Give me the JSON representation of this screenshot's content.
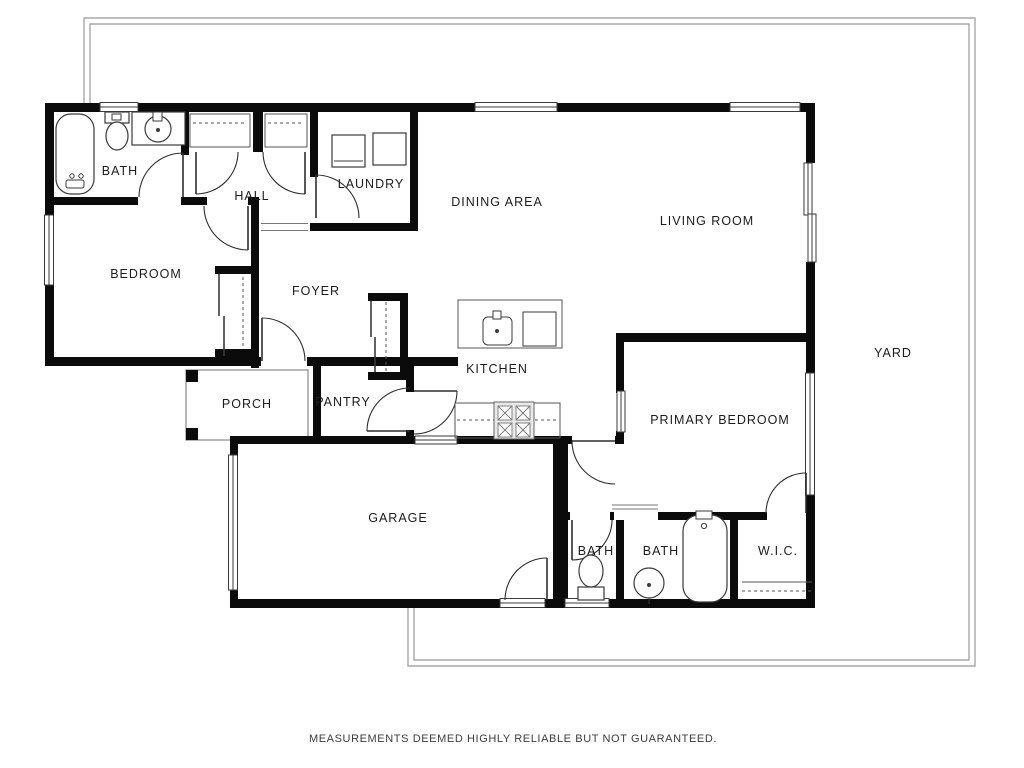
{
  "floor_plan": {
    "disclaimer": "MEASUREMENTS DEEMED HIGHLY RELIABLE BUT NOT GUARANTEED.",
    "rooms": [
      {
        "id": "bath",
        "name": "BATH"
      },
      {
        "id": "hall",
        "name": "HALL"
      },
      {
        "id": "laundry",
        "name": "LAUNDRY"
      },
      {
        "id": "dining-area",
        "name": "DINING AREA"
      },
      {
        "id": "living-room",
        "name": "LIVING ROOM"
      },
      {
        "id": "bedroom",
        "name": "BEDROOM"
      },
      {
        "id": "foyer",
        "name": "FOYER"
      },
      {
        "id": "kitchen",
        "name": "KITCHEN"
      },
      {
        "id": "porch",
        "name": "PORCH"
      },
      {
        "id": "pantry",
        "name": "PANTRY"
      },
      {
        "id": "primary-bedroom",
        "name": "PRIMARY BEDROOM"
      },
      {
        "id": "yard",
        "name": "YARD"
      },
      {
        "id": "garage",
        "name": "GARAGE"
      },
      {
        "id": "bath-2",
        "name": "BATH"
      },
      {
        "id": "bath-3",
        "name": "BATH"
      },
      {
        "id": "wic",
        "name": "W.I.C."
      }
    ],
    "colors": {
      "wall": "#0b0b0b",
      "fixture_line": "#3a3a3a",
      "yard_line": "#a9a9a9",
      "label_text": "#1c1c1c",
      "background": "#ffffff"
    },
    "fixtures": [
      "bathtub",
      "toilet",
      "sink",
      "washer",
      "dryer",
      "kitchen-island",
      "island-sink",
      "stove",
      "closet-rod",
      "garage-door",
      "windows",
      "doors"
    ]
  }
}
